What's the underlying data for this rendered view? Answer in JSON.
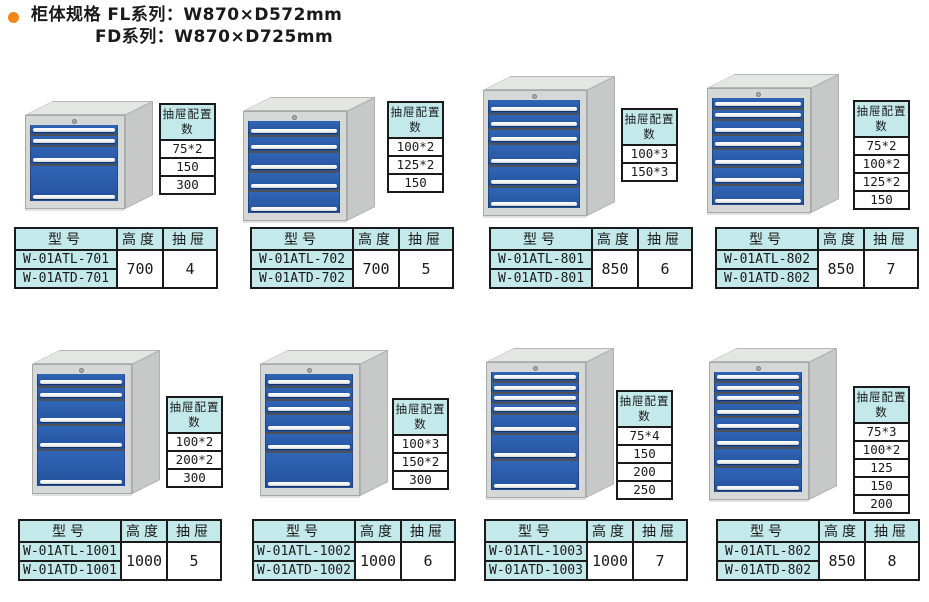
{
  "page": {
    "title_line1": "柜体规格 FL系列：W870×D572mm",
    "title_line2": "FD系列：W870×D725mm"
  },
  "labels": {
    "config_header": "抽屉配置数",
    "col_model": "型号",
    "col_height": "高度",
    "col_drawers": "抽屉"
  },
  "colors": {
    "table_header_bg": "#c4e9ea",
    "drawer_blue": "#2b5dab",
    "bullet_orange": "#f08519",
    "cabinet_gray": "#d6d8d7"
  },
  "cabinets": [
    {
      "model_a": "W-01ATL-701",
      "model_b": "W-01ATD-701",
      "height": "700",
      "drawer_count": "4",
      "config_values": [
        "75*2",
        "150",
        "300"
      ],
      "drawer_heights": [
        75,
        75,
        150,
        300
      ]
    },
    {
      "model_a": "W-01ATL-702",
      "model_b": "W-01ATD-702",
      "height": "700",
      "drawer_count": "5",
      "config_values": [
        "100*2",
        "125*2",
        "150"
      ],
      "drawer_heights": [
        100,
        100,
        125,
        125,
        150
      ]
    },
    {
      "model_a": "W-01ATL-801",
      "model_b": "W-01ATD-801",
      "height": "850",
      "drawer_count": "6",
      "config_values": [
        "100*3",
        "150*3"
      ],
      "drawer_heights": [
        100,
        100,
        100,
        150,
        150,
        150
      ]
    },
    {
      "model_a": "W-01ATL-802",
      "model_b": "W-01ATD-802",
      "height": "850",
      "drawer_count": "7",
      "config_values": [
        "75*2",
        "100*2",
        "125*2",
        "150"
      ],
      "drawer_heights": [
        75,
        75,
        100,
        100,
        125,
        125,
        150
      ]
    },
    {
      "model_a": "W-01ATL-1001",
      "model_b": "W-01ATD-1001",
      "height": "1000",
      "drawer_count": "5",
      "config_values": [
        "100*2",
        "200*2",
        "300"
      ],
      "drawer_heights": [
        100,
        100,
        200,
        200,
        300
      ]
    },
    {
      "model_a": "W-01ATL-1002",
      "model_b": "W-01ATD-1002",
      "height": "1000",
      "drawer_count": "6",
      "config_values": [
        "100*3",
        "150*2",
        "300"
      ],
      "drawer_heights": [
        100,
        100,
        100,
        150,
        150,
        300
      ]
    },
    {
      "model_a": "W-01ATL-1003",
      "model_b": "W-01ATD-1003",
      "height": "1000",
      "drawer_count": "7",
      "config_values": [
        "75*4",
        "150",
        "200",
        "250"
      ],
      "drawer_heights": [
        75,
        75,
        75,
        75,
        150,
        200,
        250
      ]
    },
    {
      "model_a": "W-01ATL-802",
      "model_b": "W-01ATD-802",
      "height": "850",
      "drawer_count": "8",
      "config_values": [
        "75*3",
        "100*2",
        "125",
        "150",
        "200"
      ],
      "drawer_heights": [
        75,
        75,
        75,
        100,
        100,
        125,
        150,
        200
      ]
    }
  ]
}
